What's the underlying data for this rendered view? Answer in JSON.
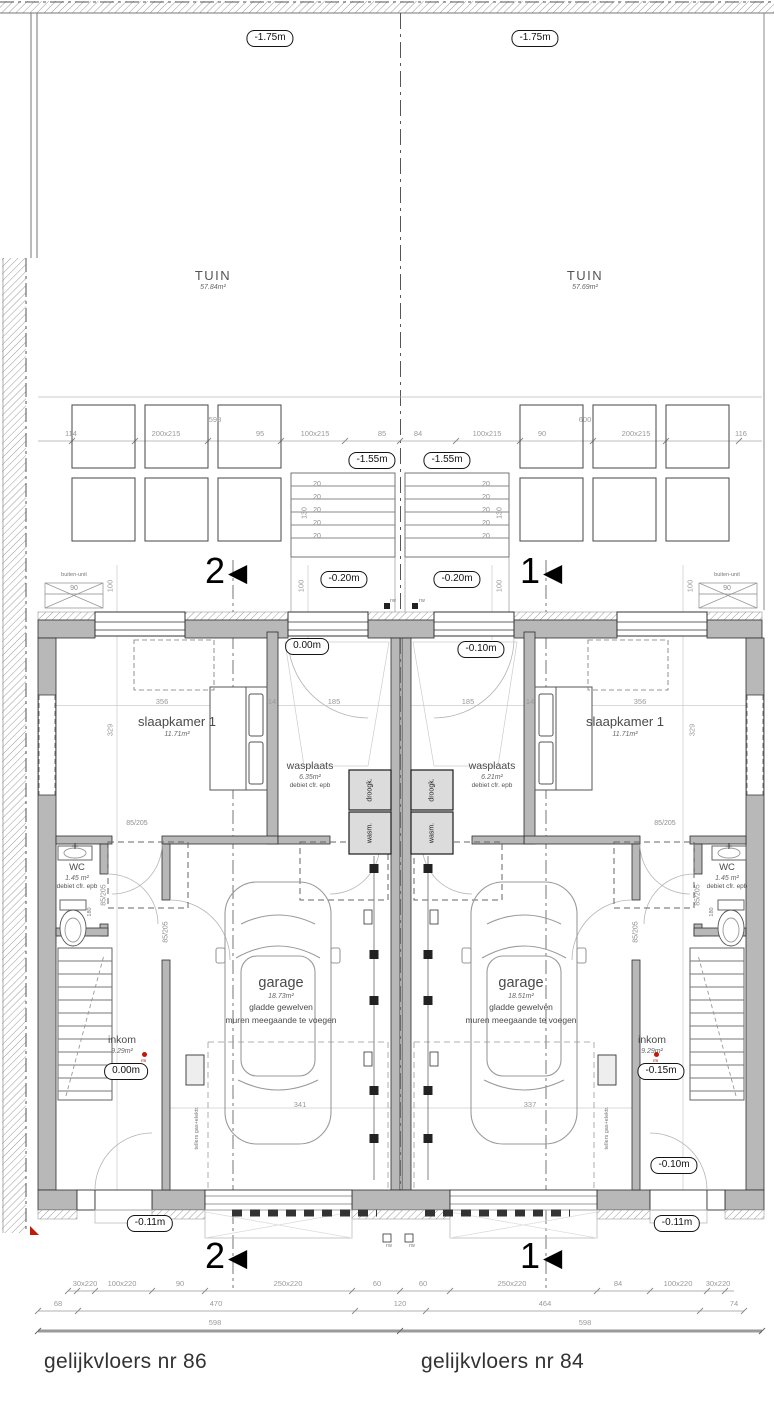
{
  "meta": {
    "plan_left_title": "gelijkvloers nr 86",
    "plan_right_title": "gelijkvloers nr 84"
  },
  "levels": {
    "garden": "-1.75m",
    "terrace": "-1.55m",
    "rear_terrace": "-0.20m",
    "ground_left": "0.00m",
    "ground_right": "-0.10m",
    "inkom_left": "0.00m",
    "inkom_right": "-0.15m",
    "front_right": "-0.10m",
    "outside": "-0.11m"
  },
  "sections": {
    "one": "1",
    "two": "2",
    "arrow": "◀"
  },
  "garden": {
    "left": {
      "name": "TUIN",
      "area": "57.84m²"
    },
    "right": {
      "name": "TUIN",
      "area": "57.69m²"
    }
  },
  "units": {
    "left": {
      "slaapkamer": {
        "name": "slaapkamer 1",
        "area": "11.71m²"
      },
      "wasplaats": {
        "name": "wasplaats",
        "area": "6.35m²",
        "note": "debiet cfr. epb"
      },
      "wc": {
        "name": "WC",
        "area": "1.45 m²",
        "note": "debiet cfr. epb"
      },
      "garage": {
        "name": "garage",
        "area": "18.73m²",
        "note1": "gladde gewelven",
        "note2": "muren meegaande te voegen"
      },
      "inkom": {
        "name": "inkom",
        "area": "9.29m²"
      }
    },
    "right": {
      "slaapkamer": {
        "name": "slaapkamer 1",
        "area": "11.71m²"
      },
      "wasplaats": {
        "name": "wasplaats",
        "area": "6.21m²",
        "note": "debiet cfr. epb"
      },
      "wc": {
        "name": "WC",
        "area": "1.45 m²",
        "note": "debiet cfr. epb"
      },
      "garage": {
        "name": "garage",
        "area": "18.51m²",
        "note1": "gladde gewelven",
        "note2": "muren meegaande te voegen"
      },
      "inkom": {
        "name": "inkom",
        "area": "9.29m²"
      }
    }
  },
  "equipment": {
    "dryer": "droogk.",
    "washer": "wasm.",
    "outdoor_unit": "buiten-unit",
    "meters": "tellers gas+elektr.",
    "rw": "rw",
    "rm": "rm"
  },
  "dims": {
    "terrace_left": [
      "114",
      "200x215",
      "95",
      "100x215",
      "85"
    ],
    "terrace_right": [
      "84",
      "100x215",
      "90",
      "200x215",
      "116"
    ],
    "terrace_total_left": "598",
    "terrace_total_right": "600",
    "rear_depth": "100",
    "outdoor_unit_width": "90",
    "stair_rise": "20",
    "stair_width": "130",
    "bedroom_left": [
      "356",
      "14",
      "185"
    ],
    "bedroom_right": [
      "185",
      "14",
      "356"
    ],
    "bedroom_depth": "329",
    "door": "85/205",
    "door_height": "180",
    "garage_left_len": "341",
    "garage_right_len": "337",
    "bottom_row1_left": [
      "30x220",
      "100x220",
      "90",
      "250x220",
      "60"
    ],
    "bottom_row1_right": [
      "60",
      "250x220",
      "84",
      "100x220",
      "30x220"
    ],
    "bottom_row2": [
      "68",
      "470",
      "120",
      "464",
      "74"
    ],
    "bottom_row3_left": "598",
    "bottom_row3_right": "598"
  }
}
